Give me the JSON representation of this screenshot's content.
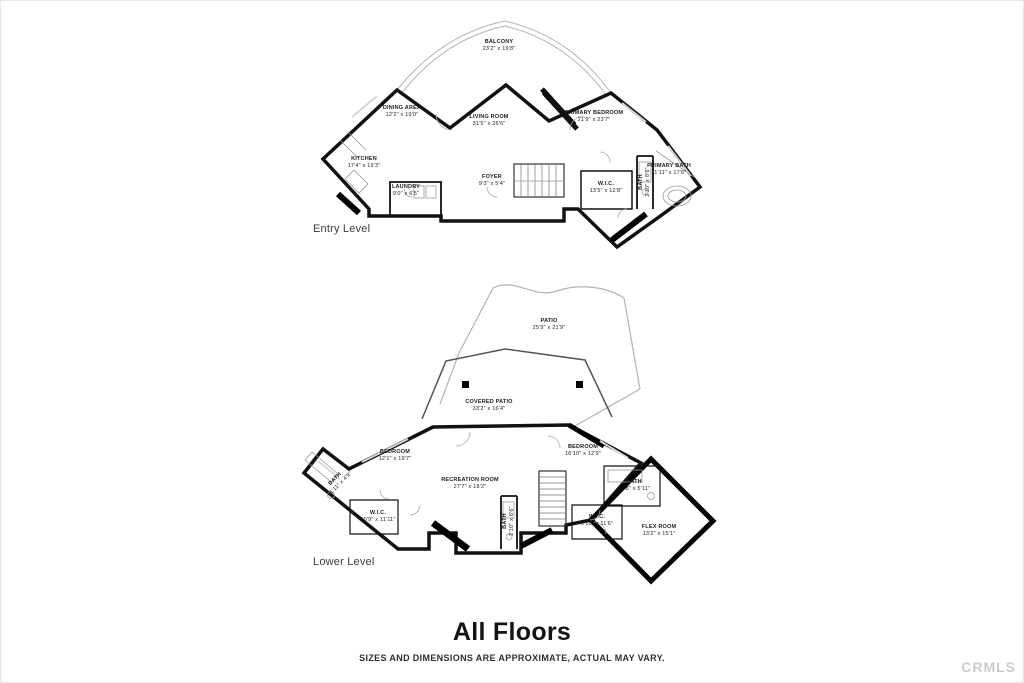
{
  "page": {
    "background": "#ffffff",
    "wall_color": "#111111",
    "light_line_color": "#aaaaaa",
    "watermark_color": "#cccccc"
  },
  "floors": [
    {
      "label": "Entry Level",
      "rooms": [
        {
          "name": "BALCONY",
          "dims": "23'2\" x 19'8\""
        },
        {
          "name": "DINING AREA",
          "dims": "12'2\" x 19'0\""
        },
        {
          "name": "LIVING ROOM",
          "dims": "31'5\" x 26'6\""
        },
        {
          "name": "PRIMARY BEDROOM",
          "dims": "21'9\" x 23'7\""
        },
        {
          "name": "KITCHEN",
          "dims": "17'4\" x 19'3\""
        },
        {
          "name": "LAUNDRY",
          "dims": "9'0\" x 6'5\""
        },
        {
          "name": "FOYER",
          "dims": "9'3\" x 5'4\""
        },
        {
          "name": "BATH",
          "dims": "2'10\" x 8'6\""
        },
        {
          "name": "PRIMARY BATH",
          "dims": "11'11\" x 17'6\""
        },
        {
          "name": "W.I.C.",
          "dims": "13'5\" x 12'8\""
        }
      ]
    },
    {
      "label": "Lower Level",
      "rooms": [
        {
          "name": "PATIO",
          "dims": "25'9\" x 21'9\""
        },
        {
          "name": "COVERED PATIO",
          "dims": "33'2\" x 16'4\""
        },
        {
          "name": "BEDROOM",
          "dims": "12'1\" x 19'7\""
        },
        {
          "name": "BEDROOM",
          "dims": "16'10\" x 12'9\""
        },
        {
          "name": "RECREATION ROOM",
          "dims": "27'7\" x 18'2\""
        },
        {
          "name": "BATH",
          "dims": "11'11\" x 4'9\""
        },
        {
          "name": "W.I.C.",
          "dims": "10'9\" x 11'11\""
        },
        {
          "name": "BATH",
          "dims": "2'10\" x 8'6\""
        },
        {
          "name": "BATH",
          "dims": "12'8\" x 5'11\""
        },
        {
          "name": "W.I.C.",
          "dims": "9'10\" x 11'6\""
        },
        {
          "name": "FLEX ROOM",
          "dims": "13'2\" x 15'1\""
        }
      ]
    }
  ],
  "footer": {
    "title": "All Floors",
    "disclaimer": "SIZES AND DIMENSIONS ARE APPROXIMATE, ACTUAL MAY VARY."
  },
  "watermark": "CRMLS"
}
